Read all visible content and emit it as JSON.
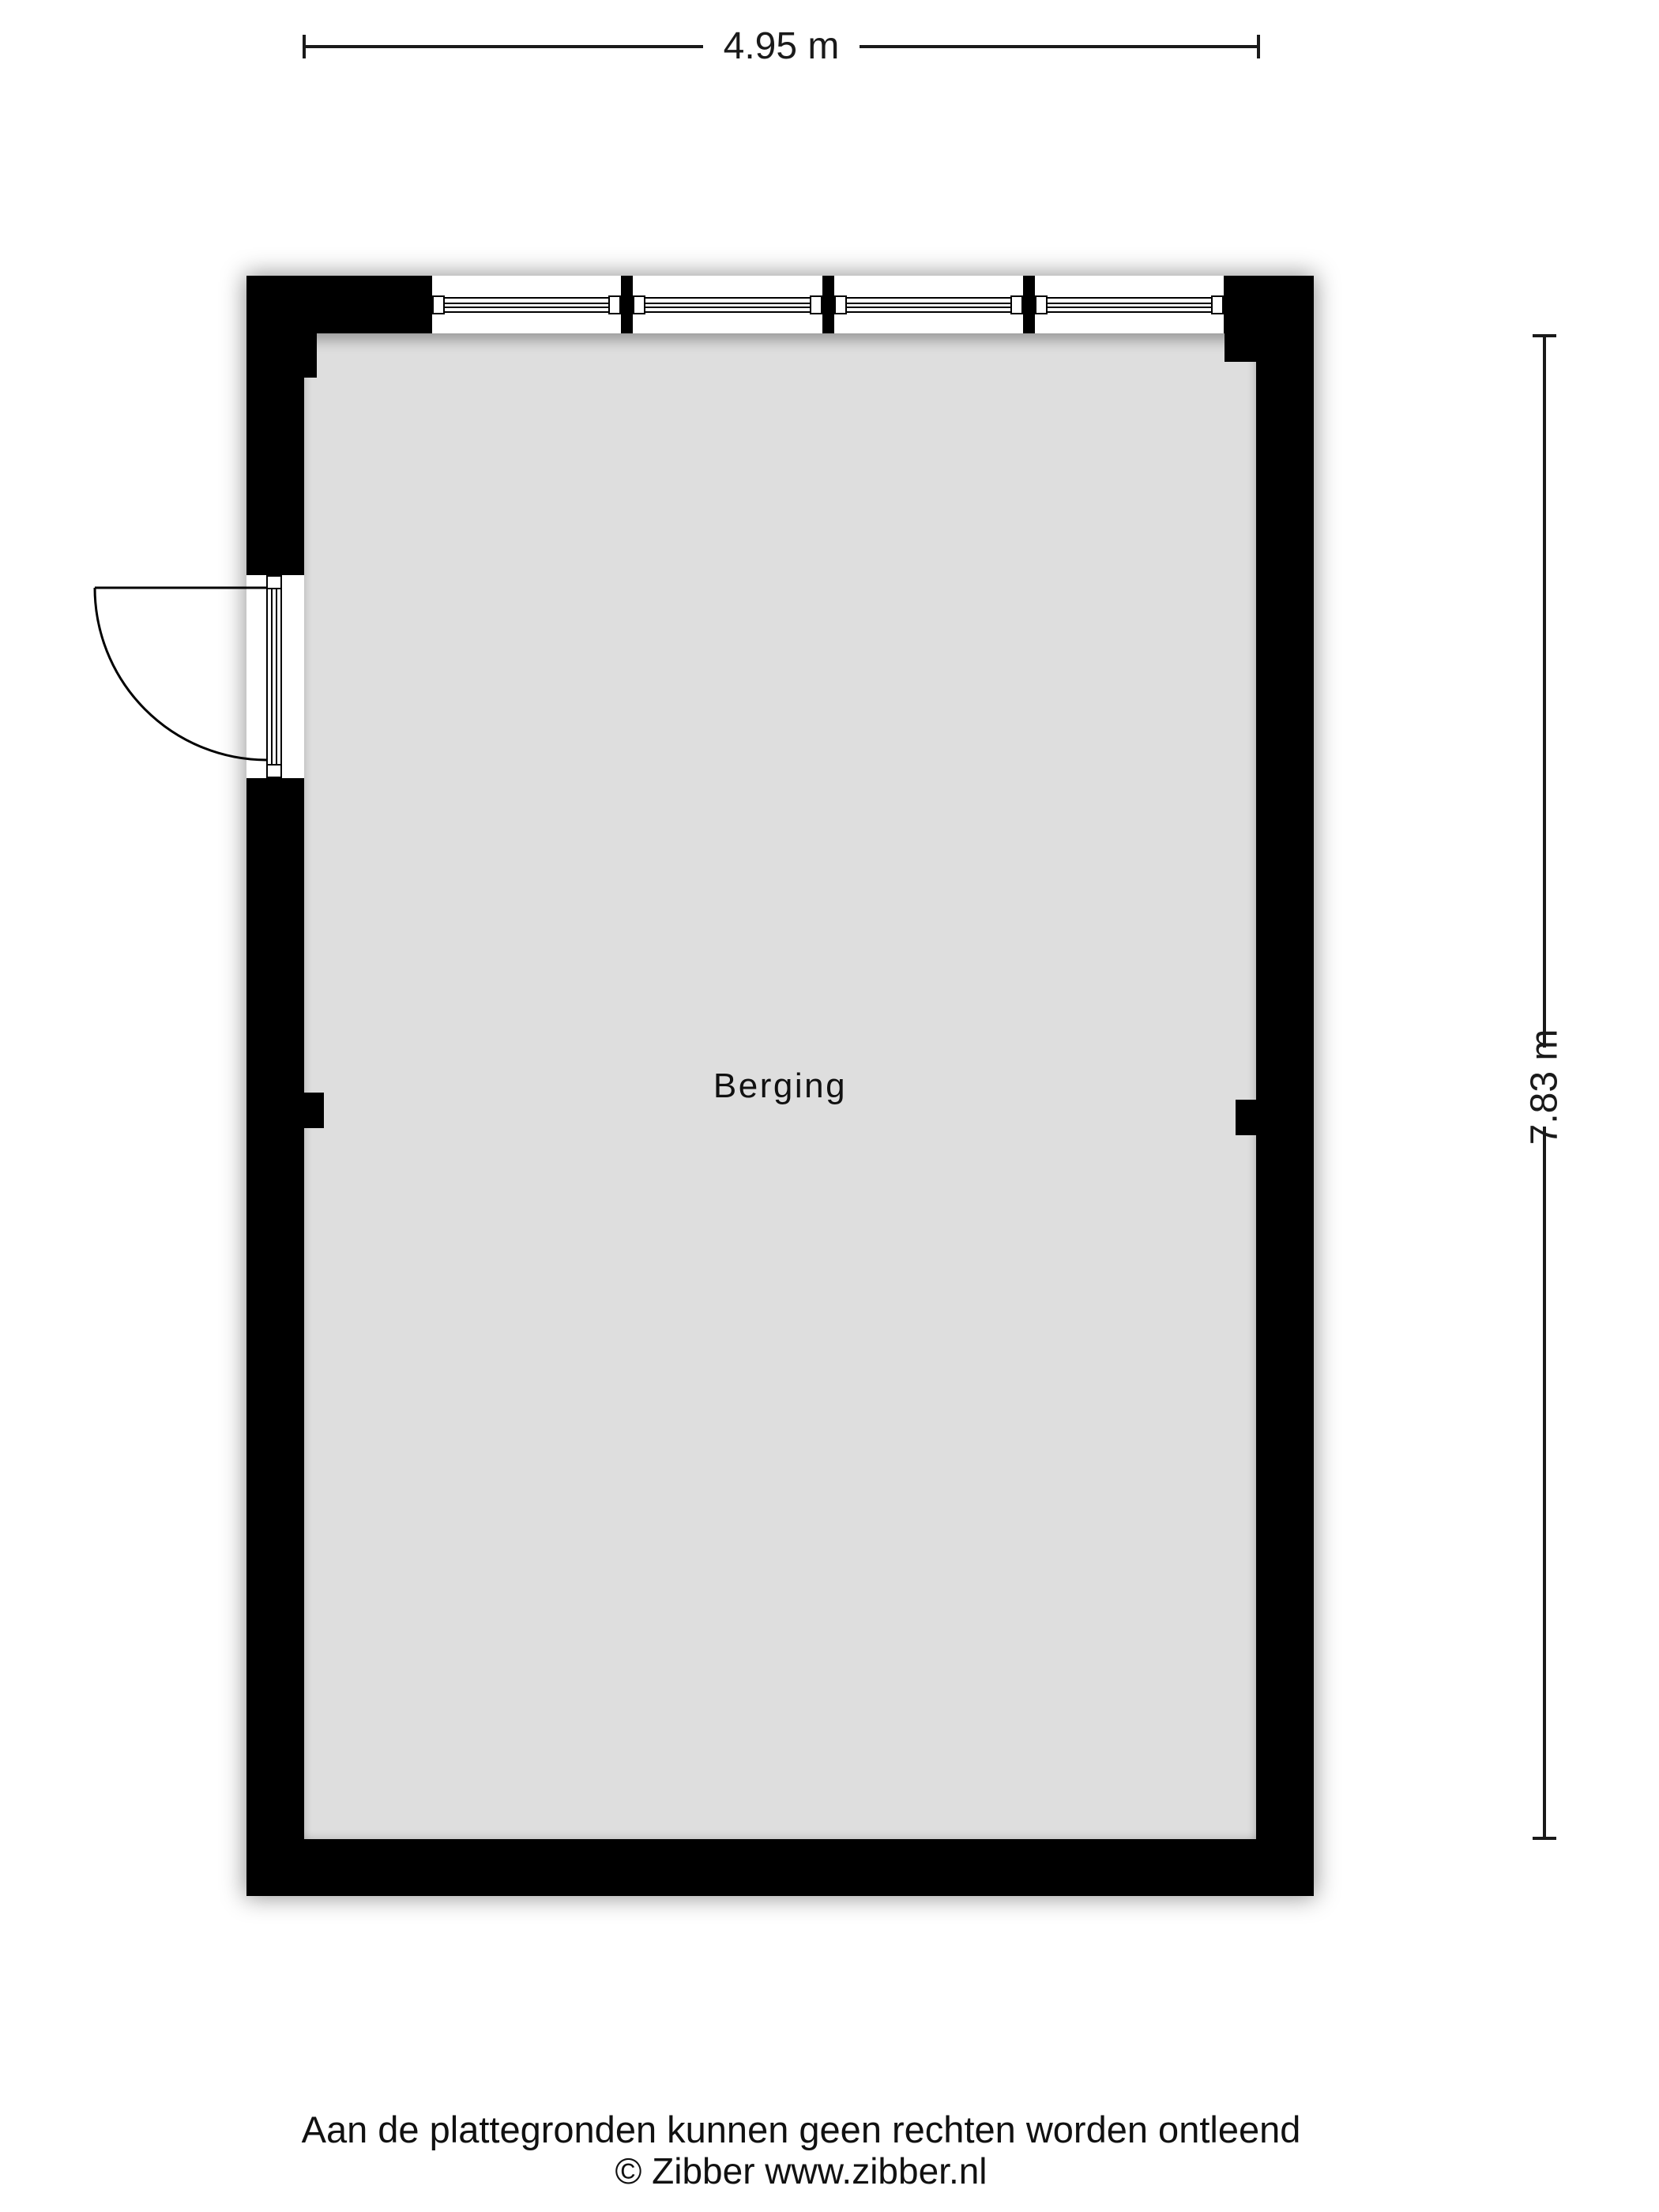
{
  "dimensions": {
    "width_label": "4.95 m",
    "height_label": "7.83 m"
  },
  "room": {
    "label": "Berging"
  },
  "footer": {
    "disclaimer": "Aan de plattegronden kunnen geen rechten worden ontleend",
    "copyright": "© Zibber www.zibber.nl"
  },
  "colors": {
    "wall": "#000000",
    "floor": "#dedede",
    "line": "#1a1a1a",
    "page": "#ffffff"
  }
}
